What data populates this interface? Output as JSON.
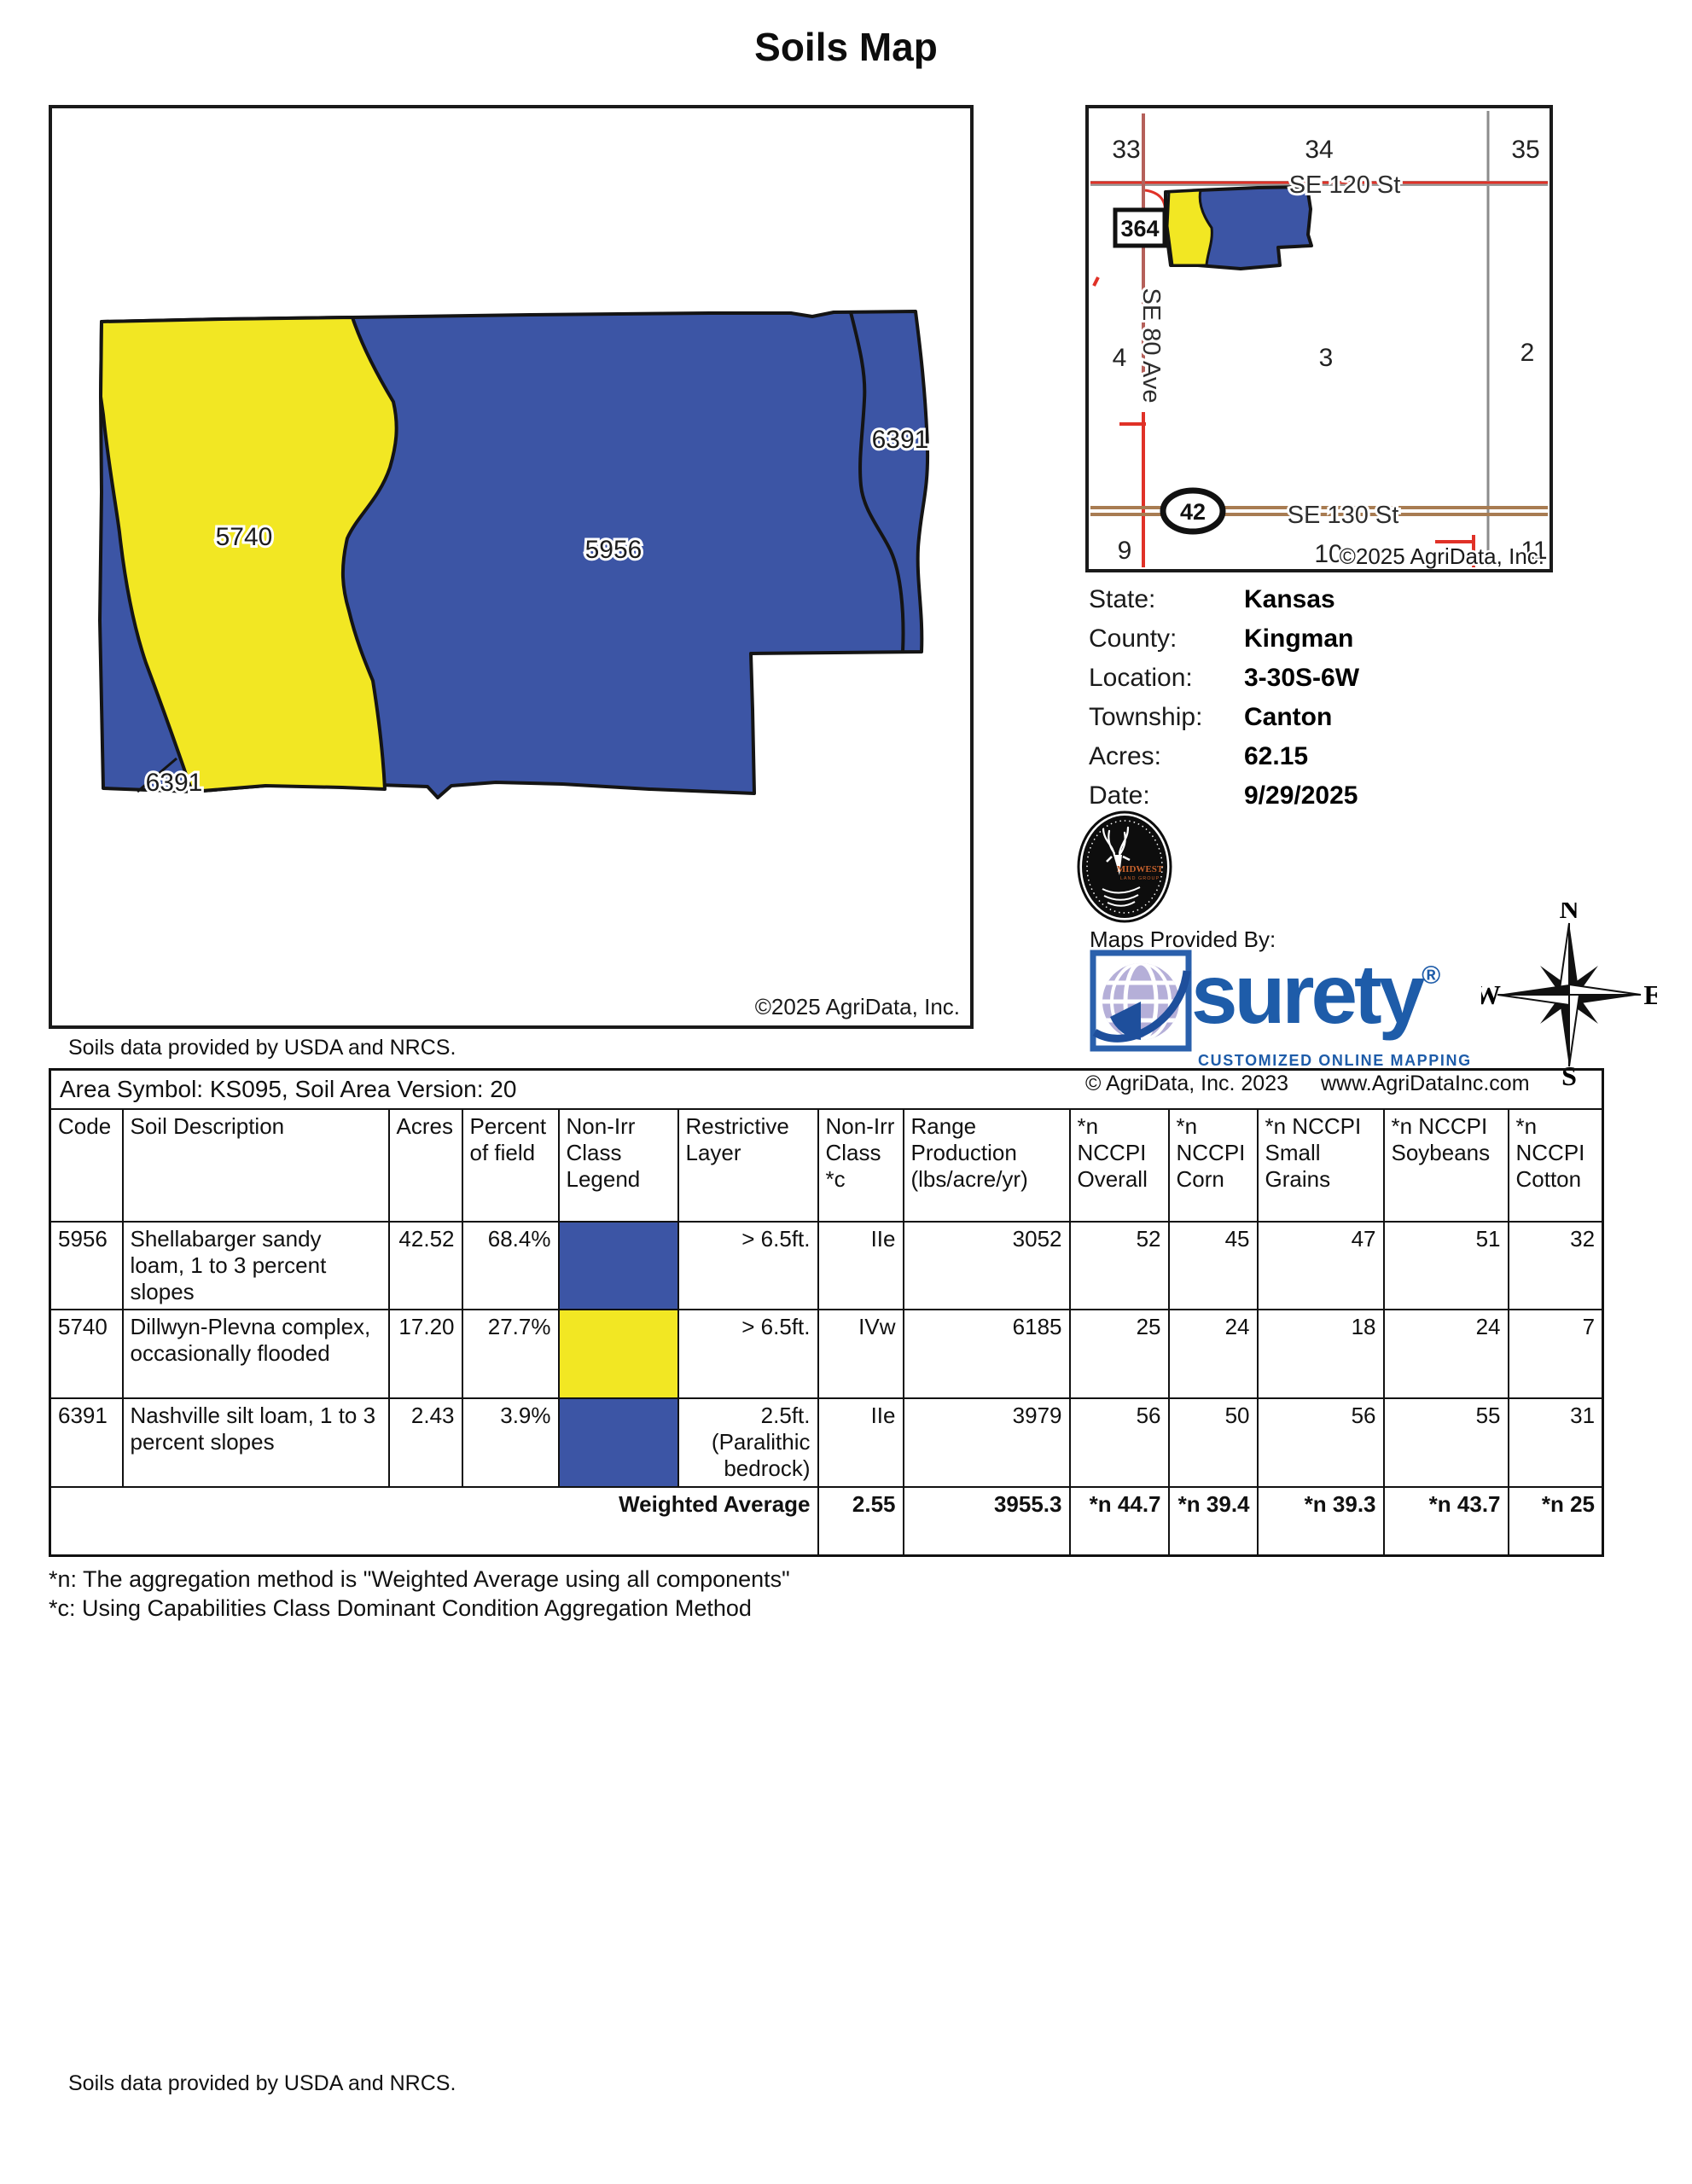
{
  "page": {
    "title": "Soils Map",
    "map_note": "Soils data provided by USDA and NRCS.",
    "footer_note": "Soils data provided by USDA and NRCS."
  },
  "colors": {
    "soil_blue": "#3C55A5",
    "soil_yellow": "#F2E723",
    "road_red": "#E03127",
    "road_red_muted": "#B5605A",
    "road_brown": "#A87C52",
    "road_gray": "#8C8C8C",
    "surety_blue": "#1E5CA9"
  },
  "main_map": {
    "labels": [
      {
        "text": "5740"
      },
      {
        "text": "5956"
      },
      {
        "text": "6391"
      },
      {
        "text": "6391"
      }
    ],
    "copyright": "©2025 AgriData, Inc."
  },
  "inset_map": {
    "section_numbers": [
      "33",
      "34",
      "35",
      "4",
      "3",
      "2",
      "9",
      "10",
      "11"
    ],
    "road_se120": "SE 120 St",
    "road_se80": "SE 80 Ave",
    "road_se130": "SE 130 St",
    "highway_box": "364",
    "highway_oval": "42",
    "copyright": "©2025 AgriData, Inc."
  },
  "info_panel": {
    "rows": [
      {
        "label": "State:",
        "value": "Kansas"
      },
      {
        "label": "County:",
        "value": "Kingman"
      },
      {
        "label": "Location:",
        "value": "3-30S-6W"
      },
      {
        "label": "Township:",
        "value": "Canton"
      },
      {
        "label": "Acres:",
        "value": "62.15"
      },
      {
        "label": "Date:",
        "value": "9/29/2025"
      }
    ]
  },
  "branding": {
    "provider_label": "Maps Provided By:",
    "midwest_name": "MIDWEST",
    "midwest_sub": "LAND GROUP",
    "surety_name": "surety",
    "surety_reg": "®",
    "surety_tagline": "CUSTOMIZED ONLINE MAPPING",
    "agridata_copyright": "© AgriData, Inc. 2023",
    "website": "www.AgriDataInc.com"
  },
  "compass": {
    "north": "N",
    "east": "E",
    "south": "S",
    "west": "W"
  },
  "soil_table": {
    "area_header": "Area Symbol: KS095, Soil Area Version: 20",
    "columns": [
      "Code",
      "Soil Description",
      "Acres",
      "Percent of field",
      "Non-Irr Class Legend",
      "Restrictive Layer",
      "Non-Irr Class *c",
      "Range Production (lbs/acre/yr)",
      "*n NCCPI Overall",
      "*n NCCPI Corn",
      "*n NCCPI Small Grains",
      "*n NCCPI Soybeans",
      "*n NCCPI Cotton"
    ],
    "rows": [
      {
        "code": "5956",
        "description": "Shellabarger sandy loam, 1 to 3 percent slopes",
        "acres": "42.52",
        "percent": "68.4%",
        "legend": "#3C55A5",
        "restrictive": "> 6.5ft.",
        "nonirr": "IIe",
        "range": "3052",
        "overall": "52",
        "corn": "45",
        "small_grains": "47",
        "soybeans": "51",
        "cotton": "32"
      },
      {
        "code": "5740",
        "description": "Dillwyn-Plevna complex, occasionally flooded",
        "acres": "17.20",
        "percent": "27.7%",
        "legend": "#F2E723",
        "restrictive": "> 6.5ft.",
        "nonirr": "IVw",
        "range": "6185",
        "overall": "25",
        "corn": "24",
        "small_grains": "18",
        "soybeans": "24",
        "cotton": "7"
      },
      {
        "code": "6391",
        "description": "Nashville silt loam, 1 to 3 percent slopes",
        "acres": "2.43",
        "percent": "3.9%",
        "legend": "#3C55A5",
        "restrictive": "2.5ft. (Paralithic bedrock)",
        "nonirr": "IIe",
        "range": "3979",
        "overall": "56",
        "corn": "50",
        "small_grains": "56",
        "soybeans": "55",
        "cotton": "31"
      }
    ],
    "weighted_average": {
      "label": "Weighted Average",
      "nonirr": "2.55",
      "range": "3955.3",
      "overall": "*n 44.7",
      "corn": "*n 39.4",
      "small_grains": "*n 39.3",
      "soybeans": "*n 43.7",
      "cotton": "*n 25"
    }
  },
  "footnotes": {
    "n": "*n: The aggregation method is \"Weighted Average using all components\"",
    "c": "*c: Using Capabilities Class Dominant Condition Aggregation Method"
  }
}
